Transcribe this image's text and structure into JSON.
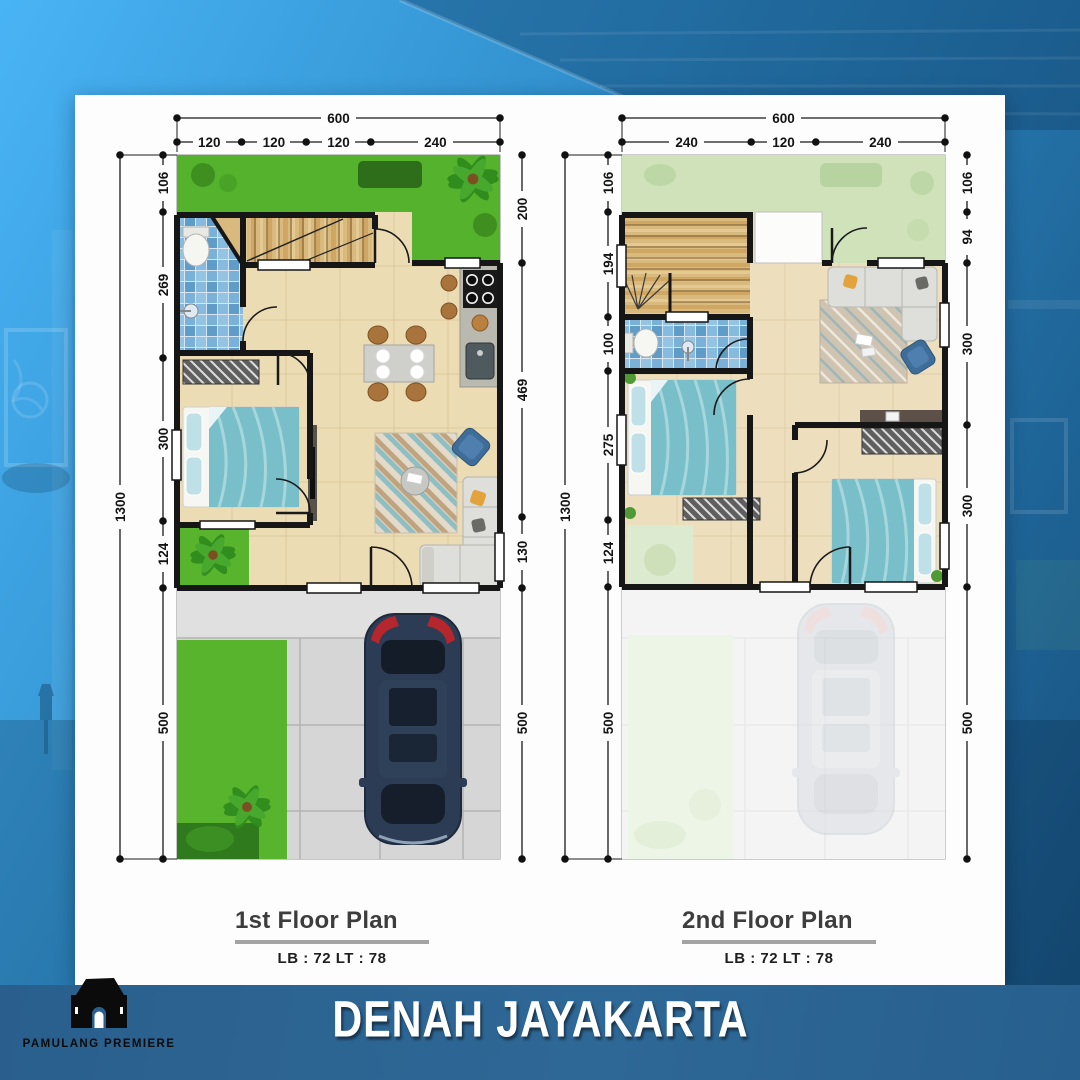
{
  "banner": {
    "title": "DENAH JAYAKARTA",
    "bg": "#2c6492"
  },
  "brand": {
    "name": "PAMULANG PREMIERE"
  },
  "plans": [
    {
      "title": "1st Floor Plan",
      "area_label": "LB : 72 LT : 78",
      "overall_width": "600",
      "overall_height": "1300",
      "top_segments": [
        "120",
        "120",
        "120",
        "240"
      ],
      "left_segments": [
        "106",
        "269",
        "300",
        "124",
        "500"
      ],
      "right_segments": [
        "200",
        "469",
        "130",
        "500"
      ]
    },
    {
      "title": "2nd Floor Plan",
      "area_label": "LB : 72 LT : 78",
      "overall_width": "600",
      "overall_height": "1300",
      "top_segments": [
        "240",
        "120",
        "240"
      ],
      "left_segments": [
        "106",
        "194",
        "100",
        "275",
        "124",
        "500"
      ],
      "right_segments": [
        "106",
        "94",
        "300",
        "300",
        "500"
      ]
    }
  ],
  "colors": {
    "banner_bg": "#2c6492",
    "card_bg": "#fdfdfd",
    "garden_green": "#56b32c",
    "faded_green": "#cfe2ba",
    "floor_cream": "#ecdcb4",
    "bath_blue": "#79b1d8",
    "stair_wood": "#d9ba7e",
    "wall_black": "#161616",
    "car_navy": "#2c3c54"
  }
}
